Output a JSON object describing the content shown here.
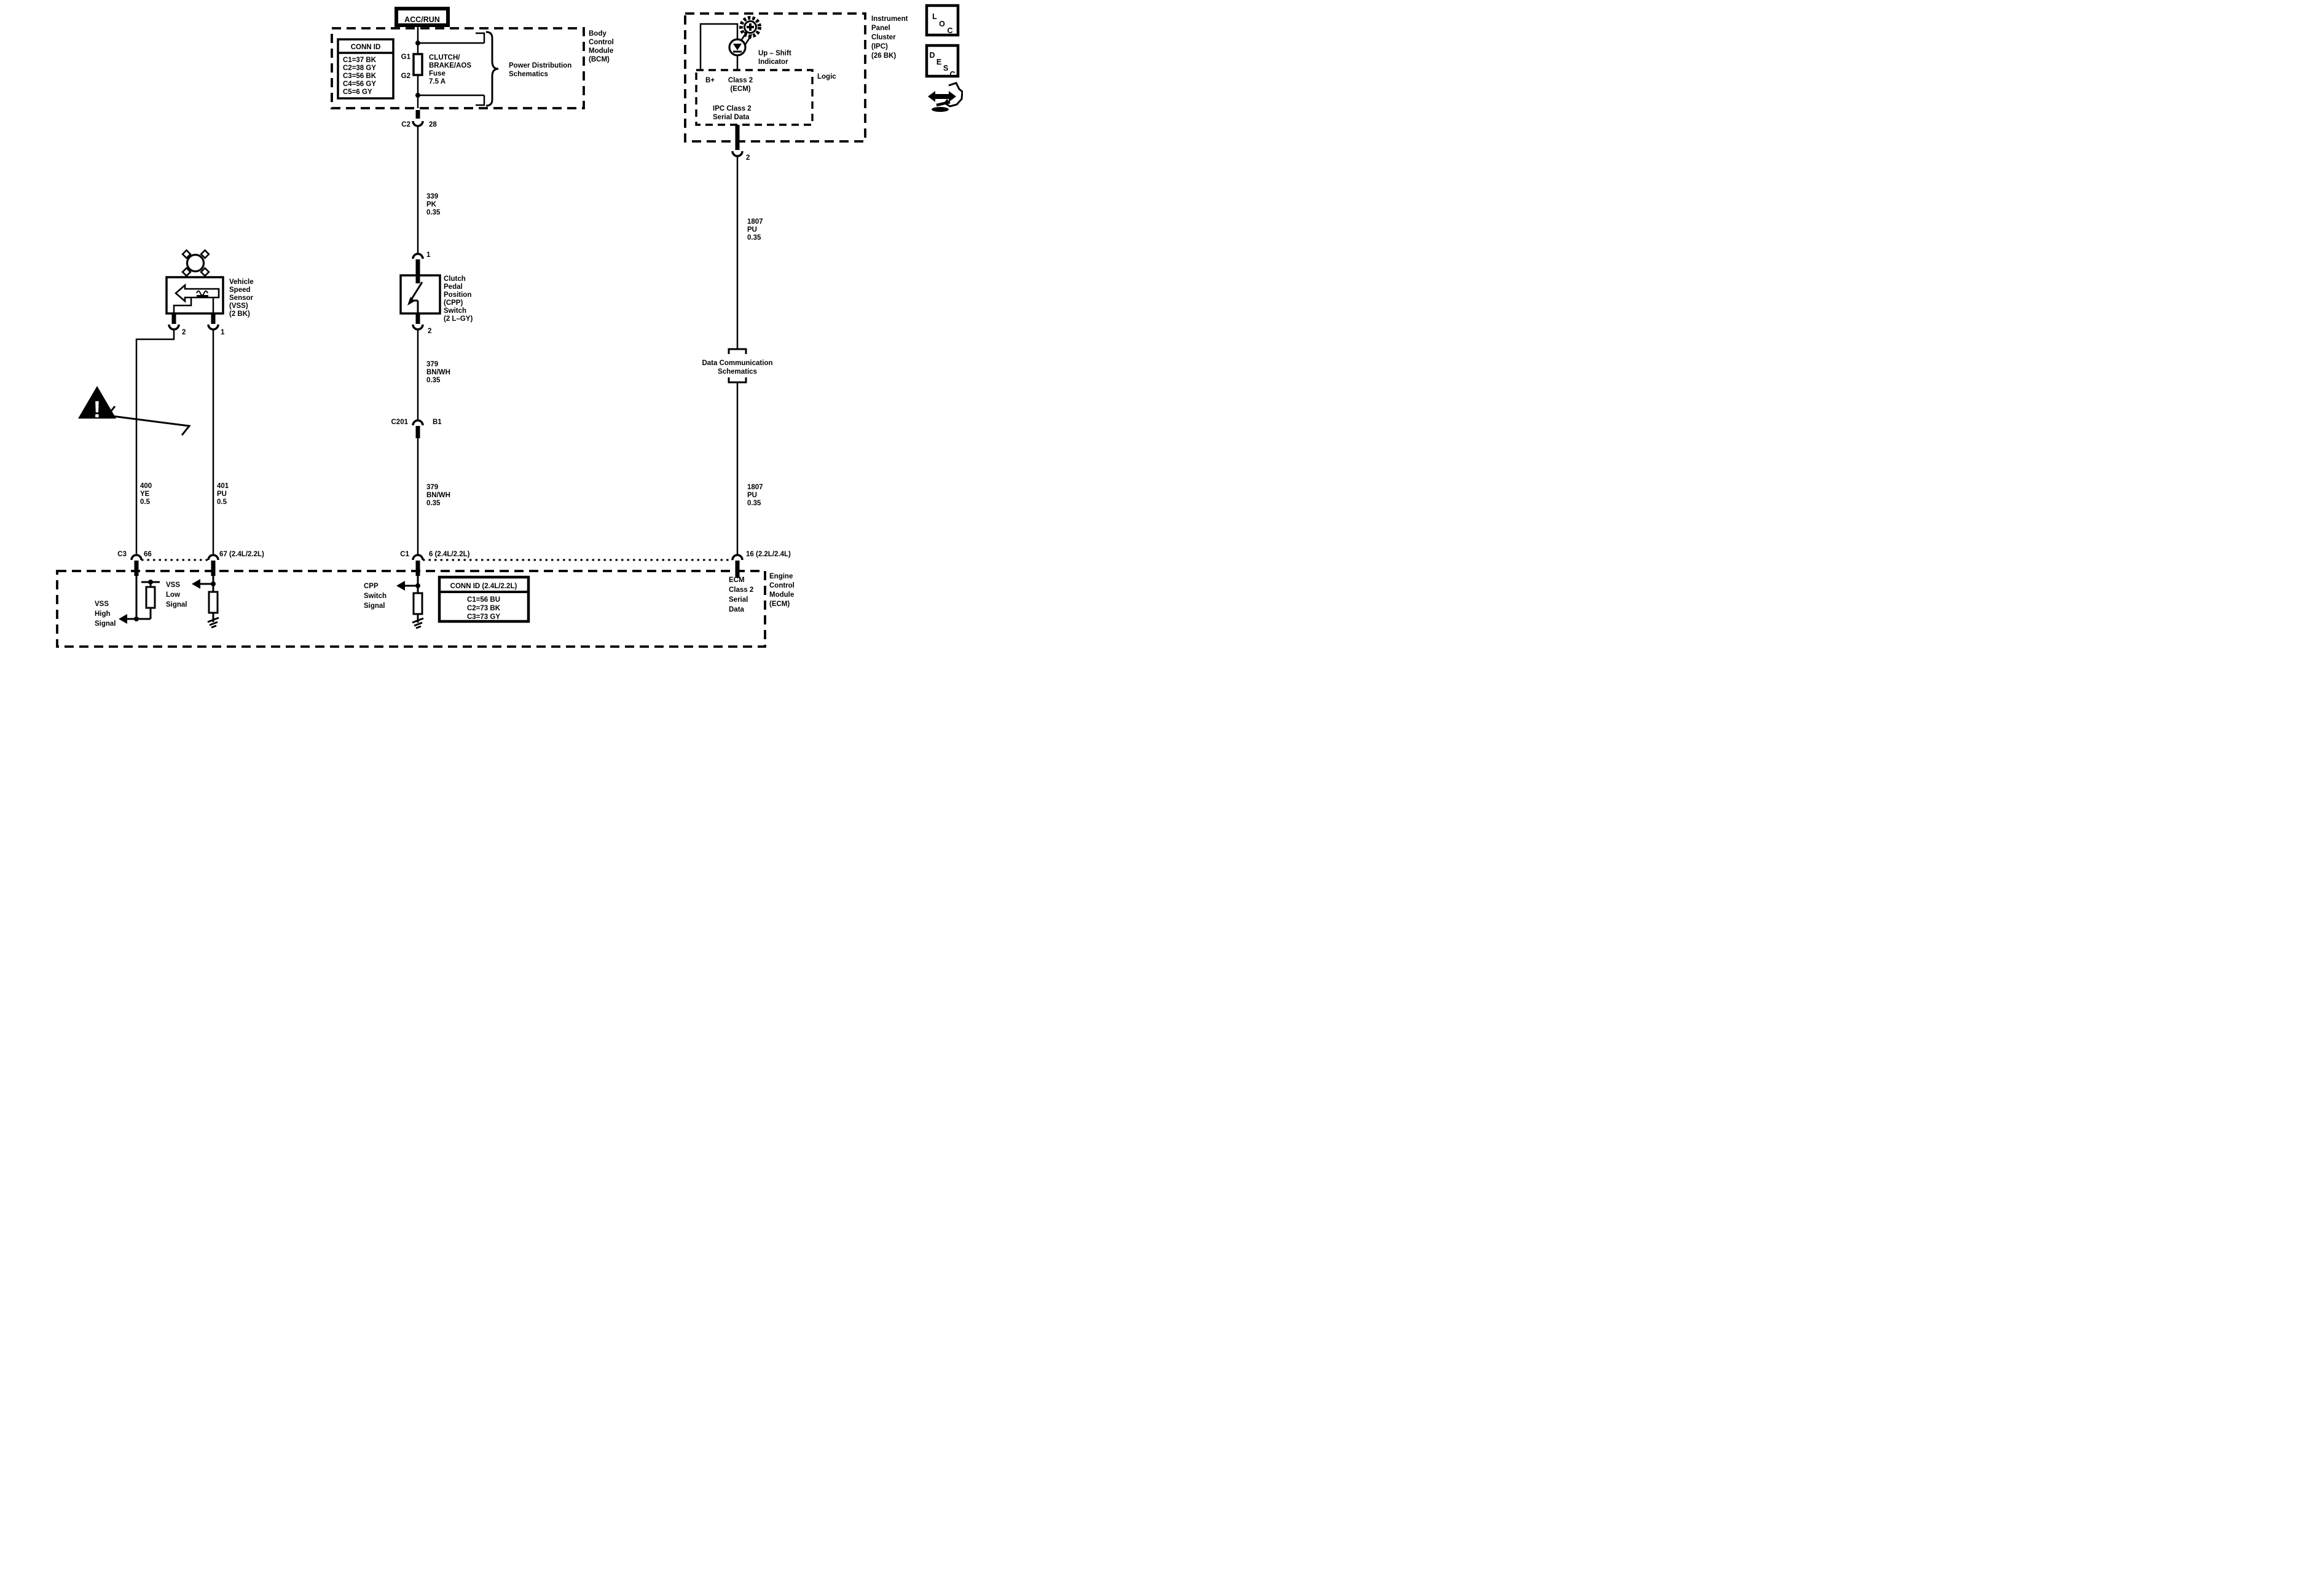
{
  "acc_run": "ACC/RUN",
  "bcm": {
    "conn_title": "CONN ID",
    "conn_rows": [
      "C1=37 BK",
      "C2=38 GY",
      "C3=56 BK",
      "C4=56 GY",
      "C5=6 GY"
    ],
    "g1": "G1",
    "g2": "G2",
    "fuse_lines": [
      "CLUTCH/",
      "BRAKE/AOS",
      "Fuse",
      "7.5 A"
    ],
    "dest_lines": [
      "Power Distribution",
      "Schematics"
    ],
    "module_lines": [
      "Body",
      "Control",
      "Module",
      "(BCM)"
    ]
  },
  "center": {
    "c2": "C2",
    "pin28": "28",
    "wire339": [
      "339",
      "PK",
      "0.35"
    ],
    "pin1": "1",
    "cpp_lines": [
      "Clutch",
      "Pedal",
      "Position",
      "(CPP)",
      "Switch",
      "(2 L–GY)"
    ],
    "pin2": "2",
    "wire379a": [
      "379",
      "BN/WH",
      "0.35"
    ],
    "c201": "C201",
    "b1": "B1",
    "wire379b": [
      "379",
      "BN/WH",
      "0.35"
    ],
    "c1": "C1",
    "pin6": "6 (2.4L/2.2L)",
    "signal_lines": [
      "CPP",
      "Switch",
      "Signal"
    ]
  },
  "left": {
    "vss_lines": [
      "Vehicle",
      "Speed",
      "Sensor",
      "(VSS)",
      "(2 BK)"
    ],
    "pin2": "2",
    "pin1": "1",
    "wire400": [
      "400",
      "YE",
      "0.5"
    ],
    "wire401": [
      "401",
      "PU",
      "0.5"
    ],
    "c3": "C3",
    "pin66": "66",
    "pin67": "67 (2.4L/2.2L)",
    "high_lines": [
      "VSS",
      "High",
      "Signal"
    ],
    "low_lines": [
      "VSS",
      "Low",
      "Signal"
    ]
  },
  "right": {
    "ipc_lines": [
      "Instrument",
      "Panel",
      "Cluster",
      "(IPC)",
      "(26 BK)"
    ],
    "upshift_lines": [
      "Up – Shift",
      "Indicator"
    ],
    "logic": "Logic",
    "bplus": "B+",
    "class2_lines": [
      "Class 2",
      "(ECM)"
    ],
    "serial_lines": [
      "IPC Class 2",
      "Serial Data"
    ],
    "pin2": "2",
    "wire1807a": [
      "1807",
      "PU",
      "0.35"
    ],
    "datacomm_lines": [
      "Data Communication",
      "Schematics"
    ],
    "wire1807b": [
      "1807",
      "PU",
      "0.35"
    ],
    "pin16": "16 (2.2L/2.4L)",
    "ecm_serial_lines": [
      "ECM",
      "Class 2",
      "Serial",
      "Data"
    ],
    "ecm_lines": [
      "Engine",
      "Control",
      "Module",
      "(ECM)"
    ]
  },
  "ecm_conn": {
    "title": "CONN ID (2.4L/2.2L)",
    "rows": [
      "C1=56 BU",
      "C2=73 BK",
      "C3=73 GY"
    ]
  },
  "corner": {
    "loc": [
      "L",
      "O",
      "C"
    ],
    "desc": [
      "D",
      "E",
      "S",
      "C"
    ]
  },
  "warning": "!",
  "colors": {
    "ink": "#000000",
    "paper": "#ffffff"
  }
}
